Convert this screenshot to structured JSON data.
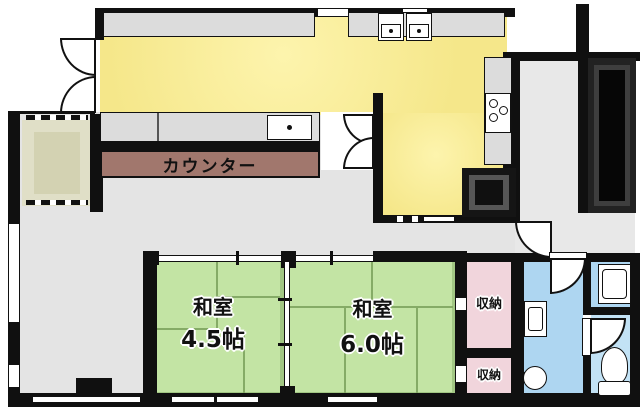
{
  "plan_title": "apartment-floor-plan",
  "labels": {
    "counter": "カウンター",
    "room1_name": "和室",
    "room1_size": "4.5帖",
    "room2_name": "和室",
    "room2_size": "6.0帖",
    "storage1": "収納",
    "storage2": "収納"
  },
  "fixtures": {
    "stove": "stove-burners-icon",
    "sinks": "kitchen-sink-icon",
    "refrigerator": "refrigerator-icon",
    "stairwell": "stairwell-icon",
    "toilet": "toilet-icon",
    "washbasin": "washbasin-icon",
    "washing_machine": "washing-machine-icon",
    "doors": "door-swing-arc-icon"
  },
  "colors": {
    "wall": "#101010",
    "kitchen_floor": "#f5e78a",
    "tatami_floor": "#c3e4a4",
    "storage_floor": "#f1d5dc",
    "washroom_floor": "#aed6f1",
    "living_floor": "#e4e4e4",
    "entry_floor": "#e0dfc7",
    "counter_bar": "#a1776d"
  }
}
